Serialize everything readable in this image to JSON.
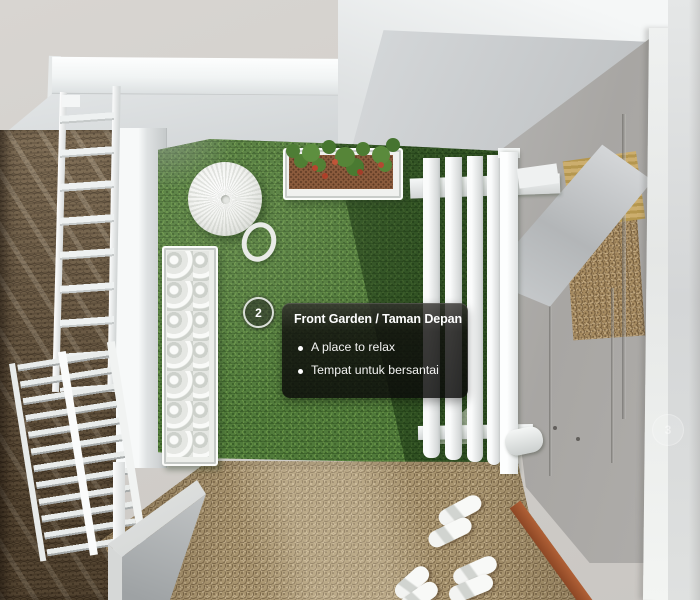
{
  "viewport": {
    "view_label": "3D top-down walkthrough of a house front garden",
    "marker": {
      "number": "2"
    },
    "faded_marker": {
      "number": "3"
    },
    "tooltip": {
      "title": "Front Garden / Taman Depan",
      "bullets": [
        "A place to relax",
        "Tempat untuk bersantai"
      ]
    },
    "colors": {
      "grass": "#507a3a",
      "grass_shadow": "#2e4f24",
      "carpet": "#a8946f",
      "wall_brown": "#6f5d45",
      "roof_white": "#f4f6f7",
      "roof_gray": "#c6c9cb",
      "door_gray": "#a9a7a4",
      "baseboard_red": "#9d5130",
      "tooltip_bg": "#121110",
      "tooltip_text": "#ffffff",
      "marker_border": "#ecefeb"
    }
  }
}
